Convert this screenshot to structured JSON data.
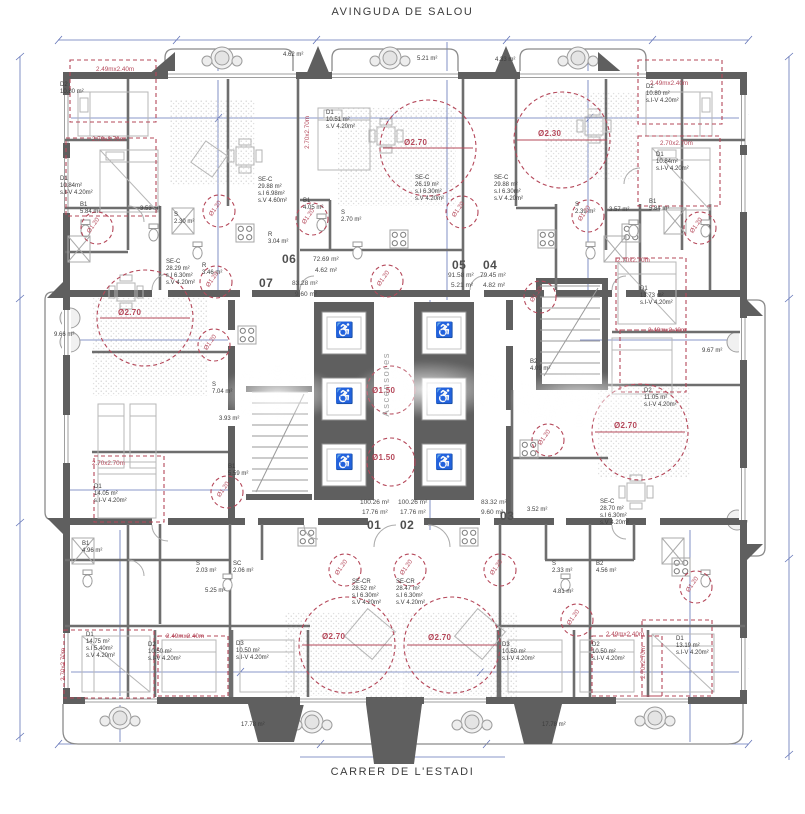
{
  "streets": {
    "top": "AVINGUDA DE SALOU",
    "bottom": "CARRER DE L'ESTADI"
  },
  "colors": {
    "wall": "#5f5f5f",
    "annotation_red": "#b5485a",
    "dimension_blue": "#6374b8"
  },
  "core": {
    "elevator_label": "Ascensores",
    "clearance_large": "Ø1.50",
    "clearance_small": "Ø1.20"
  },
  "units": [
    {
      "number": "01",
      "area": "100.26 m²",
      "terrace": "17.76 m²"
    },
    {
      "number": "02",
      "area": "100.26 m²",
      "terrace": "17.76 m²"
    },
    {
      "number": "03",
      "area": "83.32 m²",
      "terrace": "9.60 m²"
    },
    {
      "number": "04",
      "area": "79.45 m²",
      "terrace": "4.82 m²"
    },
    {
      "number": "05",
      "area": "91.58 m²",
      "terrace": "5.21 m²"
    },
    {
      "number": "06",
      "area": "72.69 m²",
      "terrace": "4.62 m²"
    },
    {
      "number": "07",
      "area": "83.28 m²",
      "terrace": "9.60 m²"
    }
  ],
  "plan_labels": [
    {
      "t": "06",
      "x": 282,
      "y": 252,
      "c": "unit",
      "n": "unit-06-number"
    },
    {
      "t": "72.69 m²",
      "x": 313,
      "y": 256,
      "c": "uarea"
    },
    {
      "t": "4.62 m²",
      "x": 315,
      "y": 267,
      "c": "uarea"
    },
    {
      "t": "07",
      "x": 259,
      "y": 276,
      "c": "unit",
      "n": "unit-07-number"
    },
    {
      "t": "83.28 m²",
      "x": 292,
      "y": 280,
      "c": "uarea"
    },
    {
      "t": "9.60 m²",
      "x": 295,
      "y": 291,
      "c": "uarea"
    },
    {
      "t": "05",
      "x": 452,
      "y": 258,
      "c": "unit",
      "n": "unit-05-number"
    },
    {
      "t": "91.58 m²",
      "x": 448,
      "y": 272,
      "c": "uarea"
    },
    {
      "t": "5.21 m²",
      "x": 451,
      "y": 282,
      "c": "uarea"
    },
    {
      "t": "04",
      "x": 483,
      "y": 258,
      "c": "unit",
      "n": "unit-04-number"
    },
    {
      "t": "79.45 m²",
      "x": 480,
      "y": 272,
      "c": "uarea"
    },
    {
      "t": "4.82 m²",
      "x": 483,
      "y": 282,
      "c": "uarea"
    },
    {
      "t": "100.26 m²",
      "x": 360,
      "y": 499,
      "c": "uarea"
    },
    {
      "t": "17.76 m²",
      "x": 362,
      "y": 509,
      "c": "uarea"
    },
    {
      "t": "01",
      "x": 367,
      "y": 518,
      "c": "unit",
      "n": "unit-01-number"
    },
    {
      "t": "100.26 m²",
      "x": 398,
      "y": 499,
      "c": "uarea"
    },
    {
      "t": "17.76 m²",
      "x": 400,
      "y": 509,
      "c": "uarea"
    },
    {
      "t": "02",
      "x": 400,
      "y": 518,
      "c": "unit",
      "n": "unit-02-number"
    },
    {
      "t": "83.32 m²",
      "x": 481,
      "y": 499,
      "c": "uarea"
    },
    {
      "t": "9.60 m²",
      "x": 481,
      "y": 509,
      "c": "uarea"
    },
    {
      "t": "03",
      "x": 500,
      "y": 509,
      "c": "unit",
      "n": "unit-03-number"
    },
    {
      "t": "SE-C\n29.88 m²\ns.I 6.98m²\ns.V 4.60m²",
      "x": 258,
      "y": 177
    },
    {
      "t": "SE-C\n26.19 m²\ns.I 6.30m²\ns.V 4.20m²",
      "x": 415,
      "y": 175
    },
    {
      "t": "SE-C\n29.88 m²\ns.I 6.30m²\ns.V 4.20m²",
      "x": 494,
      "y": 175
    },
    {
      "t": "SE-C\n28.29 m²\ns.I 6.30m²\ns.V 4.20m²",
      "x": 166,
      "y": 259
    },
    {
      "t": "SE-C\n28.70 m²\ns.I 6.30m²\ns.V 4.20m²",
      "x": 600,
      "y": 499
    },
    {
      "t": "SE-CR\n28.52 m²\ns.I 6.30m²\ns.V 4.20m²",
      "x": 352,
      "y": 579
    },
    {
      "t": "SE-CR\n28.47 m²\ns.I 6.30m²\ns.V 4.20m²",
      "x": 396,
      "y": 579
    },
    {
      "t": "D2\n10.80 m²",
      "x": 60,
      "y": 82
    },
    {
      "t": "D1\n10.84m²\ns.I-V 4.20m²",
      "x": 60,
      "y": 176
    },
    {
      "t": "D1\n10.51 m²\ns.V 4.20m²",
      "x": 326,
      "y": 110
    },
    {
      "t": "D2\n10.80 m²\ns.I-V 4.20m²",
      "x": 646,
      "y": 84
    },
    {
      "t": "D1\n10.84m²\ns.I-V 4.20m²",
      "x": 656,
      "y": 152
    },
    {
      "t": "D1\n13.73 m²\ns.I-V 4.20m²",
      "x": 640,
      "y": 286
    },
    {
      "t": "D2\n11.05 m²\ns.I-V 4.20m²",
      "x": 644,
      "y": 388
    },
    {
      "t": "D1\n14.05 m²\ns.I-V 4.20m²",
      "x": 94,
      "y": 484
    },
    {
      "t": "D1\n14.75 m²\ns.I 5.40m²\ns.V 4.20m²",
      "x": 86,
      "y": 632
    },
    {
      "t": "D2\n10.50 m²\ns.I-V 4.20m²",
      "x": 148,
      "y": 642
    },
    {
      "t": "D3\n10.50 m²\ns.I-V 4.20m²",
      "x": 236,
      "y": 641
    },
    {
      "t": "D3\n10.50 m²\ns.I-V 4.20m²",
      "x": 502,
      "y": 642
    },
    {
      "t": "D2\n10.50 m²\ns.I-V 4.20m²",
      "x": 592,
      "y": 642
    },
    {
      "t": "D1\n13.19 m²\ns.I-V 4.20m²",
      "x": 676,
      "y": 636
    },
    {
      "t": "B1\n5.84 m²",
      "x": 80,
      "y": 202
    },
    {
      "t": "3.53 m²",
      "x": 140,
      "y": 206
    },
    {
      "t": "S\n2.30 m²",
      "x": 174,
      "y": 212
    },
    {
      "t": "B1\n4.05 m²",
      "x": 303,
      "y": 198
    },
    {
      "t": "S\n2.70 m²",
      "x": 341,
      "y": 210
    },
    {
      "t": "R\n3.04 m²",
      "x": 268,
      "y": 232
    },
    {
      "t": "S\n2.39 m²",
      "x": 575,
      "y": 202
    },
    {
      "t": "3.57 m²",
      "x": 609,
      "y": 207
    },
    {
      "t": "B1\n5.84 m²",
      "x": 649,
      "y": 199
    },
    {
      "t": "R\n3.46 m²",
      "x": 202,
      "y": 263
    },
    {
      "t": "S\n7.04 m²",
      "x": 212,
      "y": 382
    },
    {
      "t": "3.93 m²",
      "x": 219,
      "y": 416
    },
    {
      "t": "B1\n5.59 m²",
      "x": 228,
      "y": 464
    },
    {
      "t": "B2\n4.09 m²",
      "x": 530,
      "y": 359
    },
    {
      "t": "3.52 m²",
      "x": 527,
      "y": 507
    },
    {
      "t": "9.66 m²",
      "x": 54,
      "y": 332
    },
    {
      "t": "9.67 m²",
      "x": 702,
      "y": 348
    },
    {
      "t": "B1\n4.96 m²",
      "x": 82,
      "y": 541
    },
    {
      "t": "S\n2.03 m²",
      "x": 196,
      "y": 561
    },
    {
      "t": "SC\n2.06 m²",
      "x": 233,
      "y": 561
    },
    {
      "t": "5.25 m²",
      "x": 205,
      "y": 588
    },
    {
      "t": "S\n2.33 m²",
      "x": 552,
      "y": 561
    },
    {
      "t": "B2\n4.56 m²",
      "x": 596,
      "y": 561
    },
    {
      "t": "4.81 m²",
      "x": 553,
      "y": 589
    },
    {
      "t": "17.78 m²",
      "x": 241,
      "y": 722
    },
    {
      "t": "17.78 m²",
      "x": 542,
      "y": 722
    },
    {
      "t": "4.62 m²",
      "x": 283,
      "y": 52
    },
    {
      "t": "5.21 m²",
      "x": 417,
      "y": 56
    },
    {
      "t": "4.33 m²",
      "x": 495,
      "y": 57
    },
    {
      "t": "2.49mx2.40m",
      "x": 96,
      "y": 66,
      "c": "red"
    },
    {
      "t": "2.70x2.70m",
      "x": 92,
      "y": 136,
      "c": "red"
    },
    {
      "t": "2.49mx2.40m",
      "x": 650,
      "y": 80,
      "c": "red"
    },
    {
      "t": "2.70x2.70m",
      "x": 660,
      "y": 140,
      "c": "red"
    },
    {
      "t": "2.70x2.70m",
      "x": 617,
      "y": 257,
      "c": "red"
    },
    {
      "t": "2.49mx2.40m",
      "x": 648,
      "y": 327,
      "c": "red"
    },
    {
      "t": "2.70x2.70m",
      "x": 92,
      "y": 460,
      "c": "red"
    },
    {
      "t": "2.49mx2.40m",
      "x": 166,
      "y": 633,
      "c": "red"
    },
    {
      "t": "2.49mx2.40m",
      "x": 606,
      "y": 631,
      "c": "red"
    },
    {
      "t": "2.70x2.70m",
      "x": 60,
      "y": 648,
      "c": "vred"
    },
    {
      "t": "2.70x2.70m",
      "x": 640,
      "y": 646,
      "c": "vred"
    },
    {
      "t": "2.70x2.70m",
      "x": 304,
      "y": 116,
      "c": "vred"
    },
    {
      "t": "Ø2.70",
      "x": 118,
      "y": 308,
      "c": "redbig"
    },
    {
      "t": "Ø2.70",
      "x": 404,
      "y": 138,
      "c": "redbig"
    },
    {
      "t": "Ø2.30",
      "x": 538,
      "y": 129,
      "c": "redbig"
    },
    {
      "t": "Ø2.70",
      "x": 614,
      "y": 421,
      "c": "redbig"
    },
    {
      "t": "Ø2.70",
      "x": 322,
      "y": 632,
      "c": "redbig"
    },
    {
      "t": "Ø2.70",
      "x": 428,
      "y": 633,
      "c": "redbig"
    },
    {
      "t": "Ø1.50",
      "x": 372,
      "y": 386,
      "c": "redbig"
    },
    {
      "t": "Ø1.50",
      "x": 372,
      "y": 453,
      "c": "redbig"
    },
    {
      "t": "Ascensores",
      "x": 381,
      "y": 352,
      "c": "asc",
      "n": "elevator-core-label"
    },
    {
      "t": "Ø1.20",
      "x": 85,
      "y": 222,
      "c": "rot"
    },
    {
      "t": "Ø1.20",
      "x": 207,
      "y": 205,
      "c": "rot"
    },
    {
      "t": "Ø1.20",
      "x": 300,
      "y": 213,
      "c": "rot"
    },
    {
      "t": "Ø1.20",
      "x": 450,
      "y": 206,
      "c": "rot"
    },
    {
      "t": "Ø1.20",
      "x": 576,
      "y": 210,
      "c": "rot"
    },
    {
      "t": "Ø1.20",
      "x": 688,
      "y": 222,
      "c": "rot"
    },
    {
      "t": "Ø1.20",
      "x": 204,
      "y": 276,
      "c": "rot"
    },
    {
      "t": "Ø1.20",
      "x": 202,
      "y": 339,
      "c": "rot"
    },
    {
      "t": "Ø1.20",
      "x": 528,
      "y": 291,
      "c": "rot"
    },
    {
      "t": "Ø1.20",
      "x": 536,
      "y": 434,
      "c": "rot"
    },
    {
      "t": "Ø1.20",
      "x": 215,
      "y": 486,
      "c": "rot"
    },
    {
      "t": "Ø1.20",
      "x": 375,
      "y": 275,
      "c": "rot"
    },
    {
      "t": "Ø1.20",
      "x": 333,
      "y": 564,
      "c": "rot"
    },
    {
      "t": "Ø1.20",
      "x": 398,
      "y": 564,
      "c": "rot"
    },
    {
      "t": "Ø1.20",
      "x": 488,
      "y": 564,
      "c": "rot"
    },
    {
      "t": "Ø1.20",
      "x": 565,
      "y": 614,
      "c": "rot"
    },
    {
      "t": "Ø1.20",
      "x": 684,
      "y": 581,
      "c": "rot"
    },
    {
      "t": "♿",
      "x": 335,
      "y": 322,
      "c": "wcg",
      "n": "wheelchair-icon"
    },
    {
      "t": "♿",
      "x": 335,
      "y": 388,
      "c": "wcg",
      "n": "wheelchair-icon"
    },
    {
      "t": "♿",
      "x": 335,
      "y": 454,
      "c": "wcg",
      "n": "wheelchair-icon"
    },
    {
      "t": "♿",
      "x": 435,
      "y": 322,
      "c": "wcg",
      "n": "wheelchair-icon"
    },
    {
      "t": "♿",
      "x": 435,
      "y": 388,
      "c": "wcg",
      "n": "wheelchair-icon"
    },
    {
      "t": "♿",
      "x": 435,
      "y": 454,
      "c": "wcg",
      "n": "wheelchair-icon"
    }
  ]
}
